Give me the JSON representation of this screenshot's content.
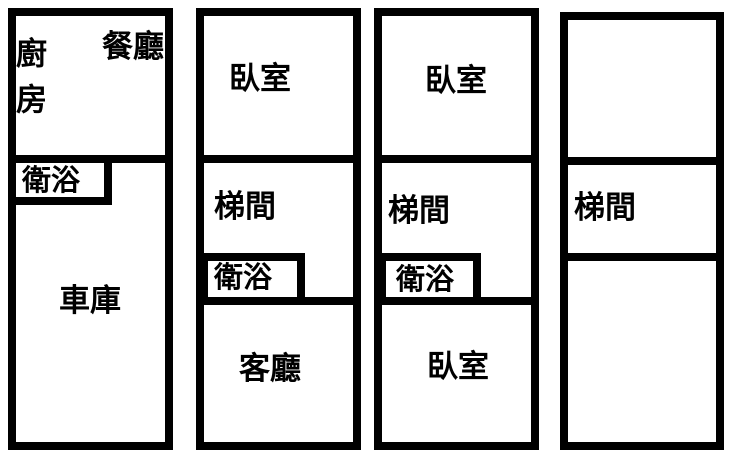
{
  "plan": {
    "background_color": "#ffffff",
    "wall_color": "#000000",
    "sections": [
      {
        "name": "section-1",
        "rooms": {
          "kitchen": "廚房",
          "dining": "餐廳",
          "bathroom": "衛浴",
          "garage": "車庫"
        }
      },
      {
        "name": "section-2",
        "rooms": {
          "bedroom": "臥室",
          "stairwell": "梯間",
          "bathroom": "衛浴",
          "living": "客廳"
        }
      },
      {
        "name": "section-3",
        "rooms": {
          "bedroom_upper": "臥室",
          "stairwell": "梯間",
          "bathroom": "衛浴",
          "bedroom_lower": "臥室"
        }
      },
      {
        "name": "section-4",
        "rooms": {
          "room_upper": "",
          "stairwell": "梯間",
          "room_lower": ""
        }
      }
    ]
  }
}
